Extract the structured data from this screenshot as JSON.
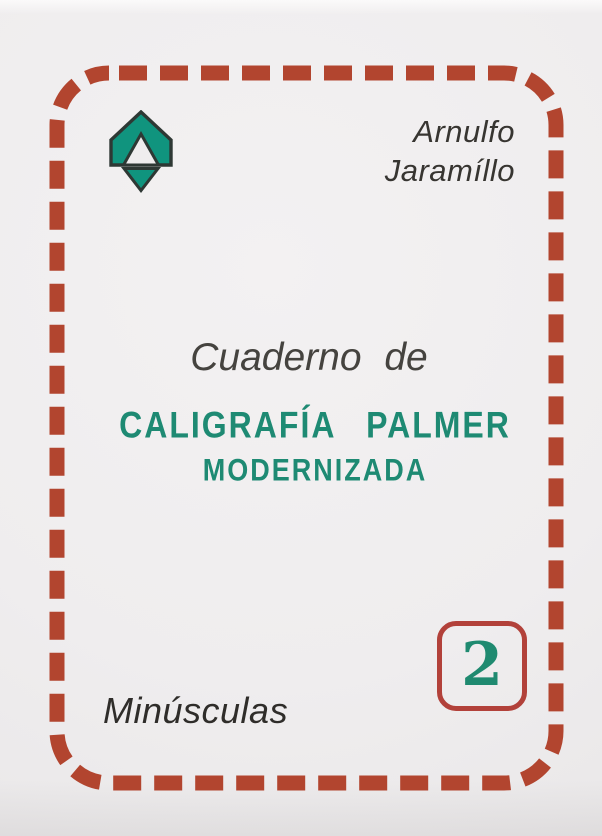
{
  "cover": {
    "author_line1": "Arnulfo",
    "author_line2": "Jaramíllo",
    "series_label": "Cuaderno de",
    "title_line1": "CALIGRAFÍA PALMER",
    "title_line2": "MODERNIZADA",
    "volume_number": "2",
    "subtitle": "Minúsculas",
    "logo": "upward-arrow-emblem",
    "colors": {
      "border_red": "#b2452f",
      "badge_red": "#b2413a",
      "logo_teal": "#10947e",
      "title_teal": "#1e8a73",
      "number_teal": "#1f8a70",
      "outline_dark": "#2e3834",
      "text_dark": "#373531",
      "background": "#efedee"
    }
  }
}
